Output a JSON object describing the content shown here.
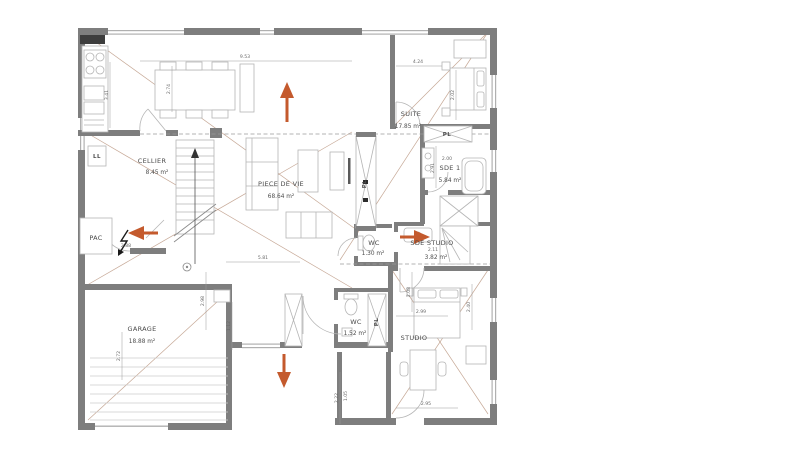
{
  "floorplan": {
    "rooms": [
      {
        "name": "CELLIER",
        "area": "8.45 m²"
      },
      {
        "name": "PIECE DE VIE",
        "area": "68.64 m²"
      },
      {
        "name": "SUITE",
        "area": "17.85 m²"
      },
      {
        "name": "SDE 1",
        "area": "5.84 m²"
      },
      {
        "name": "SDE STUDIO",
        "area": "3.82 m²"
      },
      {
        "name": "WC",
        "area": "1.30 m²"
      },
      {
        "name": "WC",
        "area": "1.52 m²"
      },
      {
        "name": "GARAGE",
        "area": "18.88 m²"
      },
      {
        "name": "STUDIO",
        "area": ""
      },
      {
        "name": "PAC",
        "area": ""
      }
    ],
    "labels": {
      "closet": "PL",
      "washer": "LL"
    },
    "dimensions": [
      "9.53",
      "4.24",
      "3.41",
      "2.74",
      "2.02",
      "2.00",
      "2.91",
      "5.81",
      "2.98",
      "2.88",
      "2.11",
      "2.08",
      "2.99",
      "2.40",
      "2.95",
      "2.22",
      "2.72",
      "1.12",
      "1.05"
    ],
    "colors": {
      "wall": "#7e7e7e",
      "furniture_line": "#b5b5b5",
      "text": "#4a4a4a",
      "arrow_accent": "#c45a2d",
      "diagonal_line": "#b38b73",
      "background": "#ffffff"
    }
  }
}
